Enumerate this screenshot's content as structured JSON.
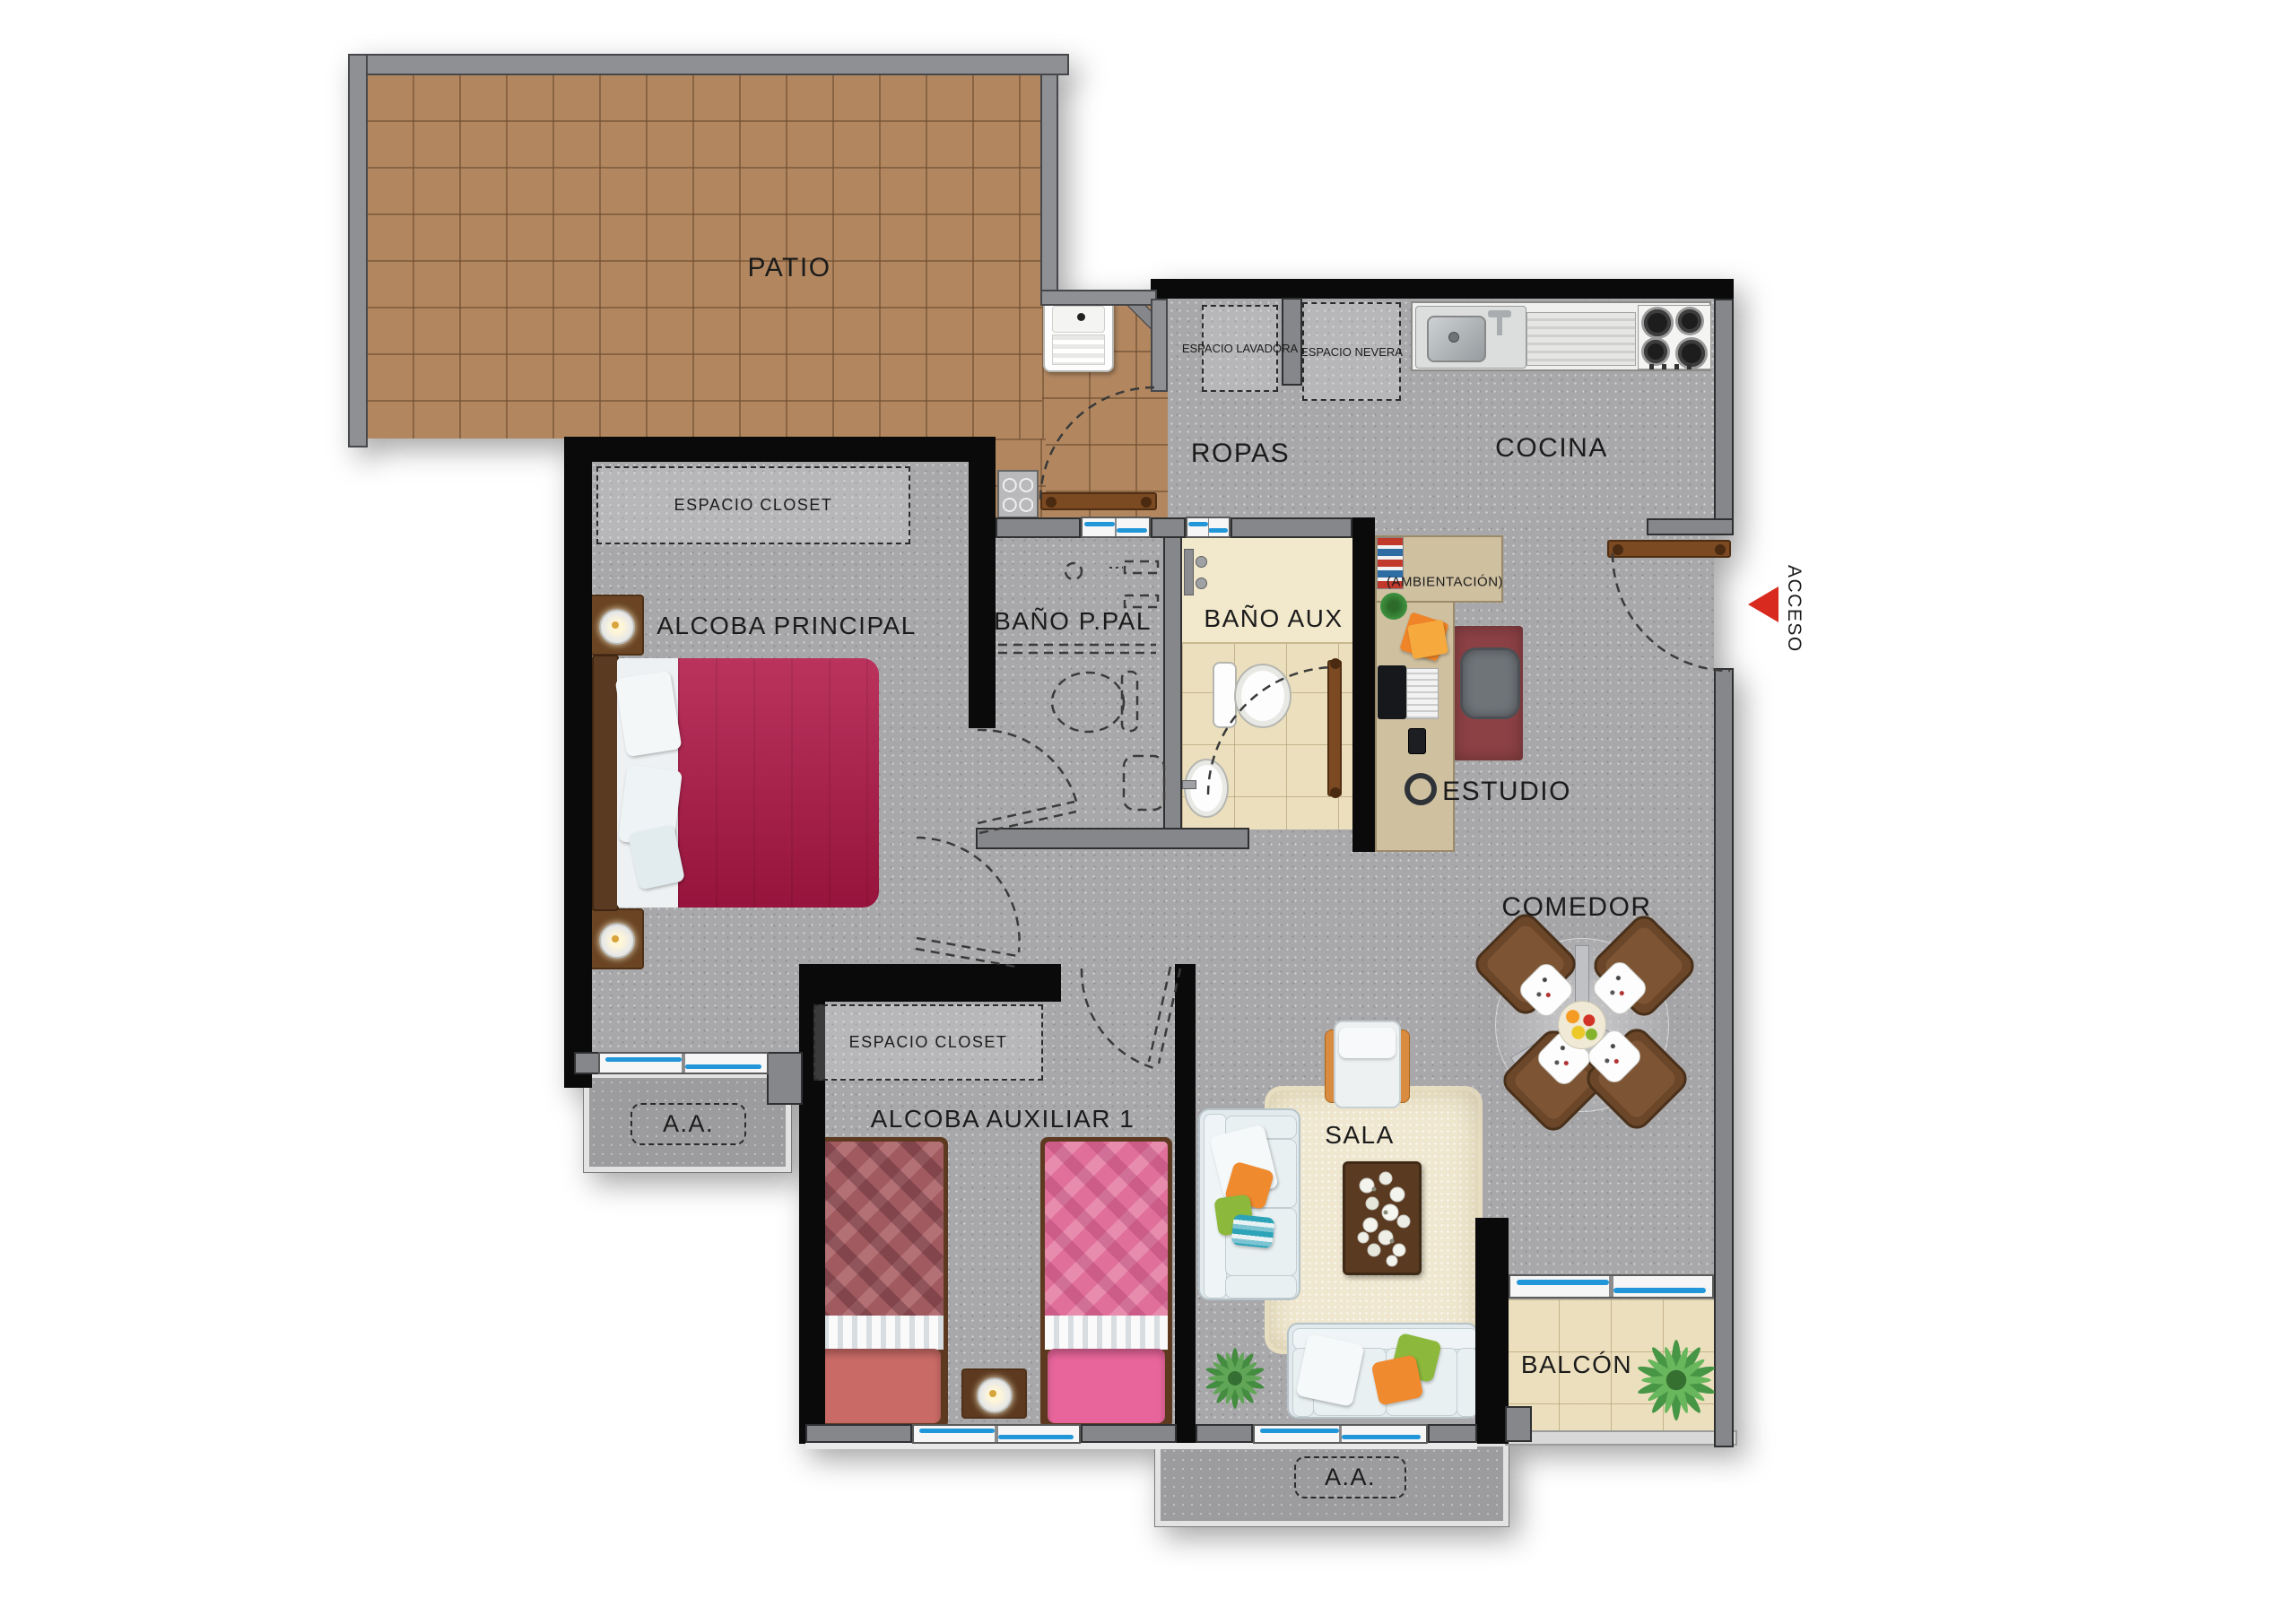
{
  "plan": {
    "type": "apartment-floor-plan",
    "labels": {
      "patio": "PATIO",
      "ropas": "ROPAS",
      "cocina": "COCINA",
      "espacio_lavadora": "ESPACIO LAVADORA",
      "espacio_nevera": "ESPACIO NEVERA",
      "espacio_closet": "ESPACIO CLOSET",
      "alcoba_principal": "ALCOBA PRINCIPAL",
      "bano_ppal": "BAÑO P.PAL",
      "bano_aux": "BAÑO AUX",
      "ambientacion": "(AMBIENTACIÓN)",
      "estudio": "ESTUDIO",
      "comedor": "COMEDOR",
      "sala": "SALA",
      "alcoba_auxiliar": "ALCOBA AUXILIAR 1",
      "espacio_closet_aux": "ESPACIO CLOSET",
      "aa": "A.A.",
      "balcon": "BALCÓN",
      "acceso": "ACCESO"
    },
    "colors": {
      "accent_red": "#d92a1f",
      "wall_black": "#0a0a0a",
      "wall_gray": "#85878a",
      "floor_gray": "#a8a8aa",
      "patio_tile": "#b28760",
      "ceramic_cream": "#ecdfbd",
      "window_glass_blue": "#2196d8",
      "bed_principal": "#b01747",
      "bed_aux_1": "#a05a60",
      "bed_aux_2": "#e06e98",
      "sofa": "#e2eaed",
      "rug_sala": "#efe7cf",
      "wood_furniture": "#6b4628",
      "desk_wood": "#cfc0a0",
      "estudio_rug": "#8c4145"
    }
  }
}
